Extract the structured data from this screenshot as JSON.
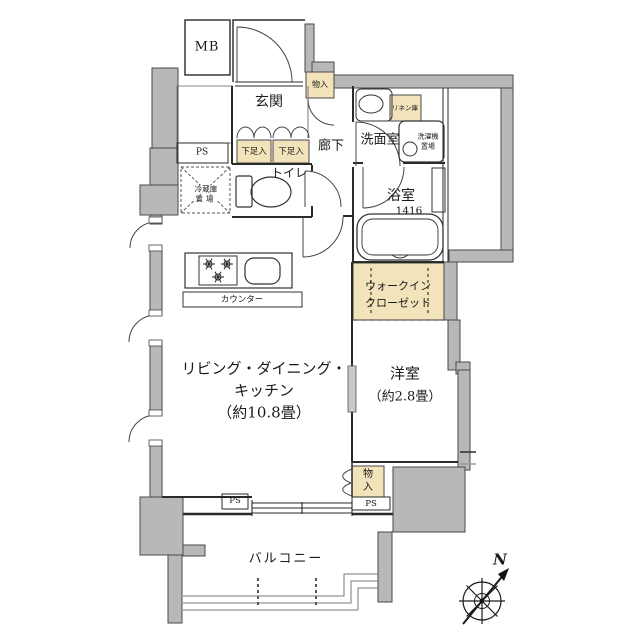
{
  "rooms": {
    "mb": {
      "label": "MB"
    },
    "entrance": {
      "label": "玄関"
    },
    "hallway": {
      "label": "廊下"
    },
    "washroom": {
      "label": "洗面室"
    },
    "toilet": {
      "label": "トイレ"
    },
    "bathroom": {
      "label": "浴室",
      "size": "1416"
    },
    "ldk": {
      "line1": "リビング・ダイニング・",
      "line2": "キッチン",
      "line3": "（約10.8畳）"
    },
    "bedroom": {
      "line1": "洋室",
      "line2": "（約2.8畳）"
    },
    "wic": {
      "line1": "ウォークイン",
      "line2": "クローゼット"
    },
    "balcony": {
      "label": "バルコニー"
    }
  },
  "storage": {
    "shoe_left": "下足入",
    "shoe_right": "下足入",
    "hall_closet": "物入",
    "bedroom_closet_char1": "物",
    "bedroom_closet_char2": "入",
    "linen": "リネン庫"
  },
  "equipment": {
    "washer_line1": "洗濯機",
    "washer_line2": "置場",
    "fridge_line1": "冷蔵庫",
    "fridge_line2": "置場",
    "counter": "カウンター"
  },
  "shafts": {
    "ps_top": "PS",
    "ps_bottom_left": "PS",
    "ps_bottom_right": "PS"
  },
  "compass": {
    "north": "N"
  },
  "colors": {
    "wall_fill": "#b8b8b8",
    "storage_fill": "#f2e3bb",
    "line": "#2a2a2a"
  }
}
